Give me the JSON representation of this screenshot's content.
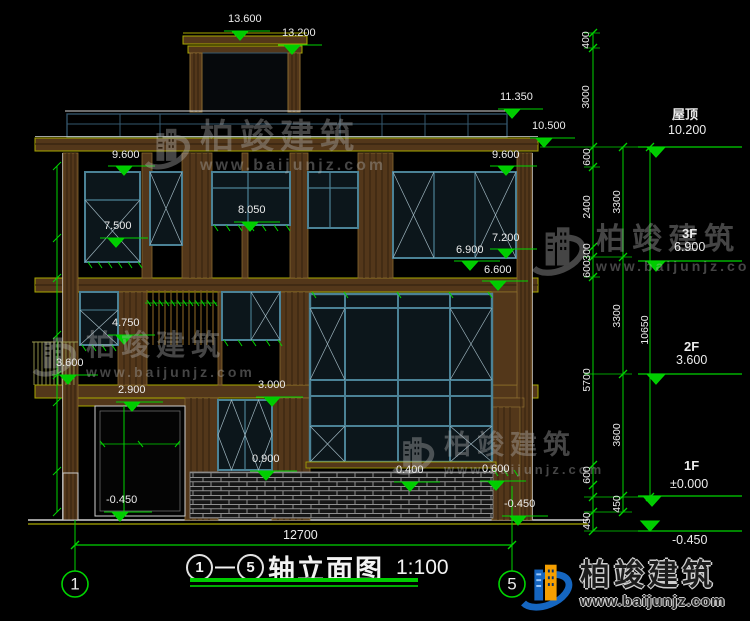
{
  "meta": {
    "axis_start": "1",
    "axis_end": "5",
    "dash": "—",
    "drawing_title_name": "轴立面图",
    "drawing_scale": "1:100"
  },
  "brand": {
    "name": "柏竣建筑",
    "url": "www.baijunjz.com"
  },
  "colors": {
    "dimension_green": "#00d400",
    "wall_brown": "#53371a",
    "frame_teal": "#4b8296",
    "line_olive": "#a8a800"
  },
  "labels": [
    {
      "t": "13.600",
      "x": 228,
      "y": 14
    },
    {
      "t": "13.200",
      "x": 282,
      "y": 28
    },
    {
      "t": "11.350",
      "x": 500,
      "y": 92
    },
    {
      "t": "10.500",
      "x": 532,
      "y": 121
    },
    {
      "t": "9.600",
      "x": 112,
      "y": 150
    },
    {
      "t": "9.600",
      "x": 492,
      "y": 150
    },
    {
      "t": "8.050",
      "x": 238,
      "y": 205
    },
    {
      "t": "7.500",
      "x": 104,
      "y": 221
    },
    {
      "t": "7.200",
      "x": 492,
      "y": 233
    },
    {
      "t": "6.900",
      "x": 456,
      "y": 245
    },
    {
      "t": "6.600",
      "x": 484,
      "y": 265
    },
    {
      "t": "4.750",
      "x": 112,
      "y": 318
    },
    {
      "t": "3.600",
      "x": 56,
      "y": 358
    },
    {
      "t": "3.000",
      "x": 258,
      "y": 380
    },
    {
      "t": "2.900",
      "x": 118,
      "y": 385
    },
    {
      "t": "0.900",
      "x": 252,
      "y": 454
    },
    {
      "t": "0.400",
      "x": 396,
      "y": 465
    },
    {
      "t": "0.600",
      "x": 482,
      "y": 464
    },
    {
      "t": "-0.450",
      "x": 106,
      "y": 495
    },
    {
      "t": "-0.450",
      "x": 504,
      "y": 499
    },
    {
      "t": "12700",
      "x": 283,
      "y": 529,
      "cls": "lg"
    },
    {
      "t": "屋顶",
      "x": 672,
      "y": 108,
      "cls": "fl"
    },
    {
      "t": "10.200",
      "x": 668,
      "y": 124,
      "cls": "lg"
    },
    {
      "t": "3F",
      "x": 682,
      "y": 227,
      "cls": "fl"
    },
    {
      "t": "6.900",
      "x": 674,
      "y": 241,
      "cls": "lg"
    },
    {
      "t": "2F",
      "x": 684,
      "y": 340,
      "cls": "fl"
    },
    {
      "t": "3.600",
      "x": 676,
      "y": 354,
      "cls": "lg"
    },
    {
      "t": "1F",
      "x": 684,
      "y": 459,
      "cls": "fl"
    },
    {
      "t": "±0.000",
      "x": 670,
      "y": 478,
      "cls": "lg"
    },
    {
      "t": "-0.450",
      "x": 672,
      "y": 534,
      "cls": "lg"
    },
    {
      "t": "400",
      "x": 586,
      "y": 40,
      "cls": "v"
    },
    {
      "t": "3000",
      "x": 586,
      "y": 97,
      "cls": "v"
    },
    {
      "t": "600",
      "x": 587,
      "y": 157,
      "cls": "v"
    },
    {
      "t": "2400",
      "x": 587,
      "y": 207,
      "cls": "v"
    },
    {
      "t": "300",
      "x": 587,
      "y": 252,
      "cls": "v"
    },
    {
      "t": "600",
      "x": 587,
      "y": 269,
      "cls": "v"
    },
    {
      "t": "5700",
      "x": 587,
      "y": 380,
      "cls": "v"
    },
    {
      "t": "600",
      "x": 587,
      "y": 475,
      "cls": "v"
    },
    {
      "t": "450",
      "x": 587,
      "y": 521,
      "cls": "v"
    },
    {
      "t": "3300",
      "x": 617,
      "y": 202,
      "cls": "v"
    },
    {
      "t": "3300",
      "x": 617,
      "y": 316,
      "cls": "v"
    },
    {
      "t": "3600",
      "x": 617,
      "y": 435,
      "cls": "v"
    },
    {
      "t": "450",
      "x": 617,
      "y": 504,
      "cls": "v"
    },
    {
      "t": "10650",
      "x": 645,
      "y": 330,
      "cls": "v"
    },
    {
      "t": "1",
      "x": 75,
      "y": 584,
      "cls": "bubble"
    },
    {
      "t": "5",
      "x": 512,
      "y": 584,
      "cls": "bubble"
    }
  ],
  "watermarks": [
    {
      "x": 140,
      "y": 120,
      "text_px": 34,
      "url_px": 16,
      "logo_px": 52
    },
    {
      "x": 526,
      "y": 218,
      "text_px": 30,
      "url_px": 14,
      "logo_px": 62
    },
    {
      "x": 28,
      "y": 330,
      "text_px": 29,
      "url_px": 14,
      "logo_px": 50
    },
    {
      "x": 388,
      "y": 430,
      "text_px": 27,
      "url_px": 13,
      "logo_px": 48
    }
  ]
}
